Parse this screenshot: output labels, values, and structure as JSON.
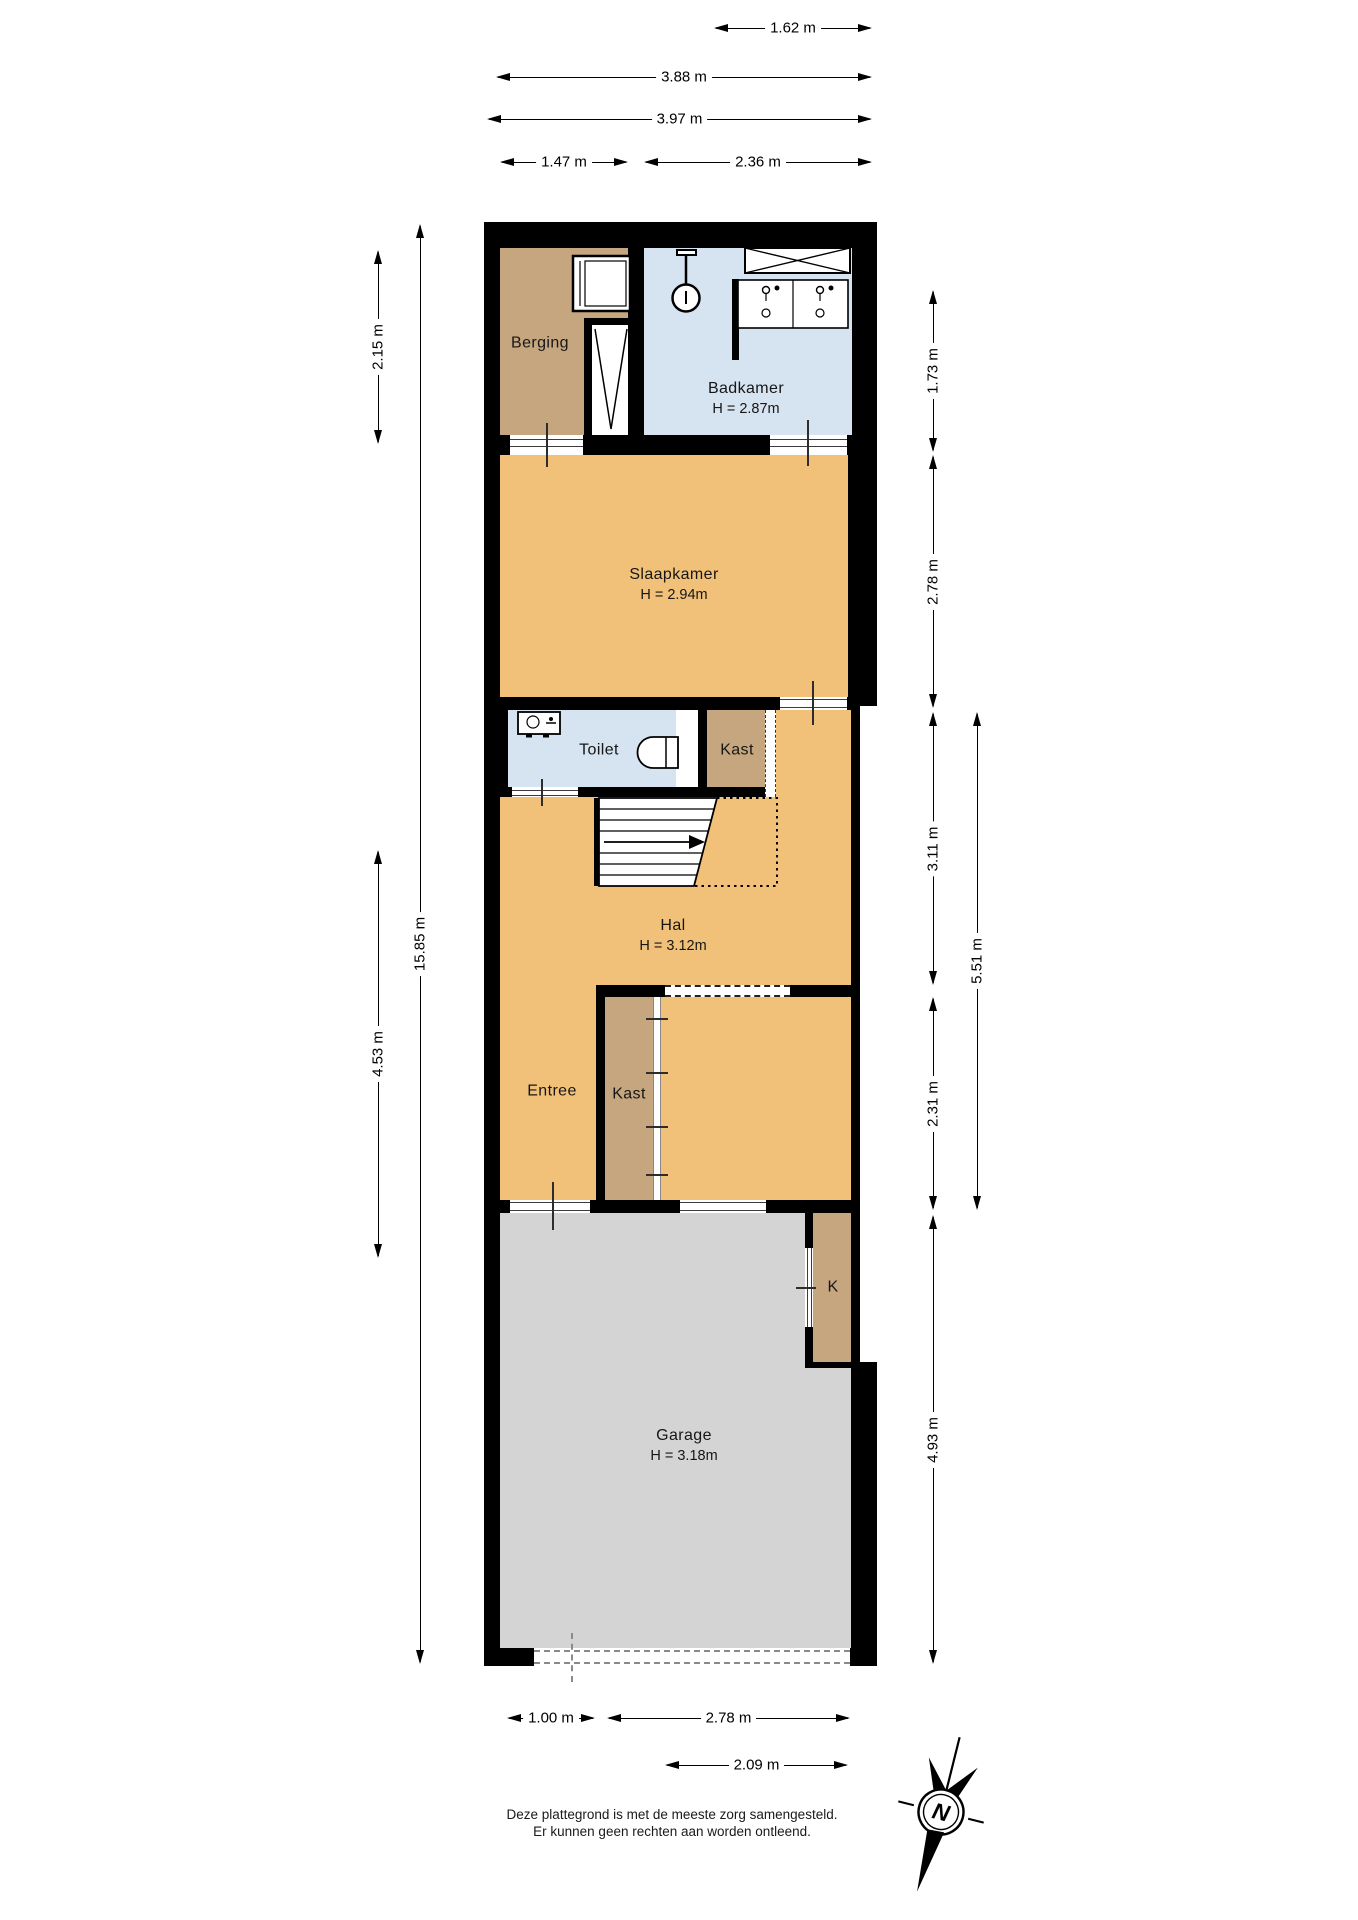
{
  "colors": {
    "wall": "#000000",
    "orange": "#F2C179",
    "tan": "#C6A67F",
    "blue": "#D6E3F0",
    "gray": "#D4D4D4"
  },
  "rooms": {
    "berging": {
      "name": "Berging"
    },
    "badkamer": {
      "name": "Badkamer",
      "h": "H = 2.87m"
    },
    "slaapkamer": {
      "name": "Slaapkamer",
      "h": "H = 2.94m"
    },
    "toilet": {
      "name": "Toilet"
    },
    "kast_boven": {
      "name": "Kast"
    },
    "hal": {
      "name": "Hal",
      "h": "H = 3.12m"
    },
    "entree": {
      "name": "Entree"
    },
    "kast_onder": {
      "name": "Kast"
    },
    "k": {
      "name": "K"
    },
    "garage": {
      "name": "Garage",
      "h": "H = 3.18m"
    }
  },
  "dims": {
    "t1": "1.62 m",
    "t2": "3.88 m",
    "t3": "3.97 m",
    "t4": "1.47 m",
    "t5": "2.36 m",
    "l1": "2.15 m",
    "l2": "4.53 m",
    "l3": "15.85 m",
    "r1": "1.73 m",
    "r2": "2.78 m",
    "r3": "3.11 m",
    "r4": "2.31 m",
    "r5": "4.93 m",
    "r6": "5.51 m",
    "b1": "1.00 m",
    "b2": "2.78 m",
    "b3": "2.09 m"
  },
  "compass": {
    "n": "N"
  },
  "footer": {
    "line1": "Deze plattegrond is met de meeste zorg samengesteld.",
    "line2": "Er kunnen geen rechten aan worden ontleend."
  }
}
